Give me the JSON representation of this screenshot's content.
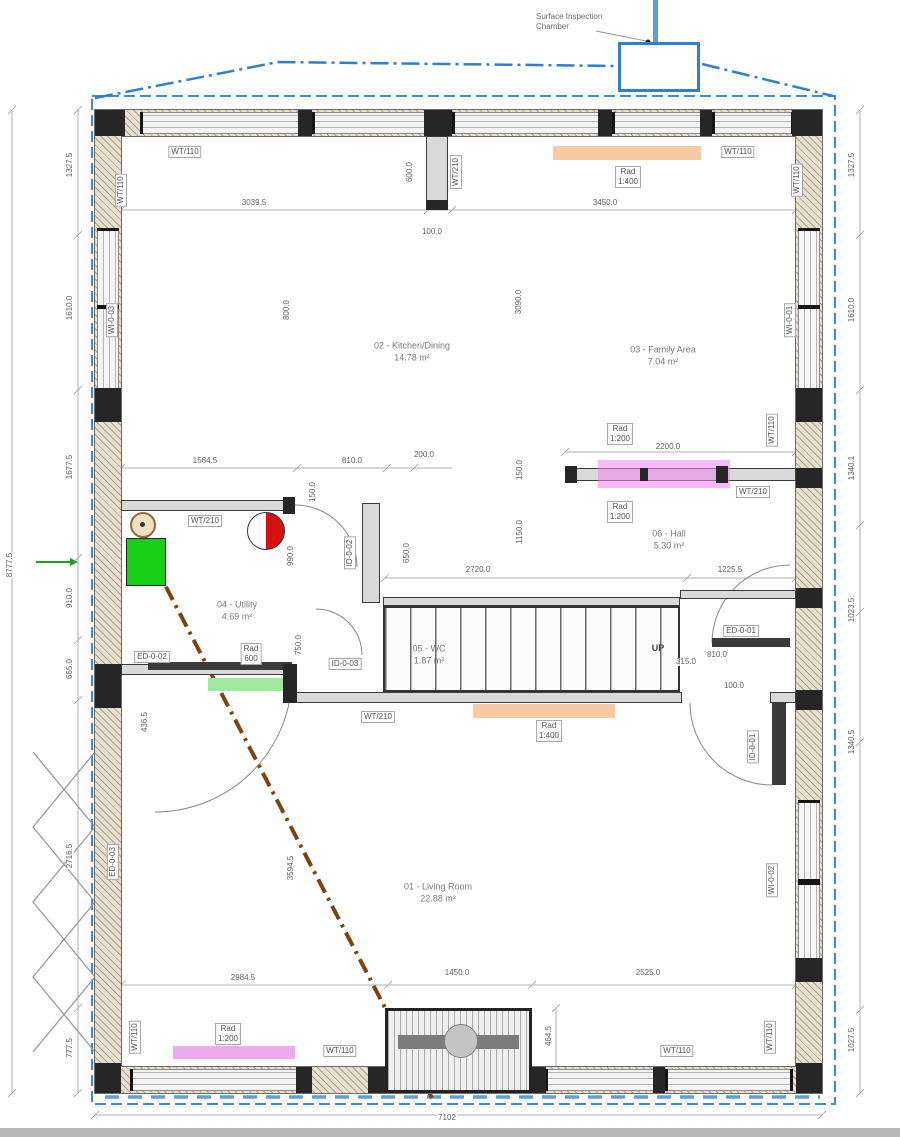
{
  "annotations": {
    "surface_line1": "Surface Inspection",
    "surface_line2": "Chamber",
    "up": "UP"
  },
  "rooms": [
    {
      "name": "02 - Kitchen/Dining",
      "area": "14.78 m²"
    },
    {
      "name": "03 - Family Area",
      "area": "7.04 m²"
    },
    {
      "name": "06 - Hall",
      "area": "5.30 m²"
    },
    {
      "name": "04 - Utility",
      "area": "4.69 m²"
    },
    {
      "name": "05 - WC",
      "area": "1.87 m²"
    },
    {
      "name": "01 - Living Room",
      "area": "22.88 m²"
    }
  ],
  "tags": {
    "wt110": "WT/110",
    "wt210": "WT/210",
    "ed01": "ED-0-01",
    "ed02": "ED-0-02",
    "ed03": "ED-0-03",
    "id01": "ID-0-01",
    "id02": "ID-0-02",
    "id03": "ID-0-03",
    "wi01": "WI-0-01",
    "wi02": "WI-0-02",
    "wi03": "WI-0-03"
  },
  "radiators": {
    "word": "Rad",
    "spec_1400": "1:400",
    "spec_1200": "1:200",
    "spec_600": "600"
  },
  "dims": {
    "top_left": "3039.5",
    "top_right": "3450.0",
    "stub_h": "600.0",
    "stub_gap": "100.0",
    "kitchen_w": "800.0",
    "kitchen_h": "3090.0",
    "hall_rad": "2200.0",
    "hall_off": "150.0",
    "util_a": "1584.5",
    "util_b": "810.0",
    "util_c": "200.0",
    "util_d": "150.0",
    "util_e": "990.0",
    "util_f": "650.0",
    "util_g": "750.0",
    "util_h": "436.5",
    "stair_w": "2720.0",
    "hall_b": "1225.5",
    "hall_h": "1150.0",
    "stair_off": "315.0",
    "door_a": "810.0",
    "door_b": "100.0",
    "liv_h": "3594.5",
    "bot_a": "2984.5",
    "bot_b": "1450.0",
    "bot_c": "2525.0",
    "chim_d": "464.5",
    "overall_w": "7102",
    "left": [
      "1327.5",
      "1610.0",
      "1677.5",
      "910.0",
      "665.0",
      "2716.5",
      "777.5"
    ],
    "far_left": "8777.5",
    "right": [
      "1327.5",
      "1610.0",
      "1340.1",
      "1023.5",
      "1340.5",
      "1027.5"
    ]
  },
  "colors": {
    "boundary_blue": "#2f7fd0",
    "drain_brown": "#7a4512",
    "rad_orange": "#f6c9a2",
    "rad_pink": "#eeaaee",
    "rad_green": "#9fe89f",
    "appliance_green": "#17cf17",
    "symbol_red": "#d51212",
    "fence_gray": "#9a9a9a",
    "arrow_green": "#1f9d1f"
  }
}
